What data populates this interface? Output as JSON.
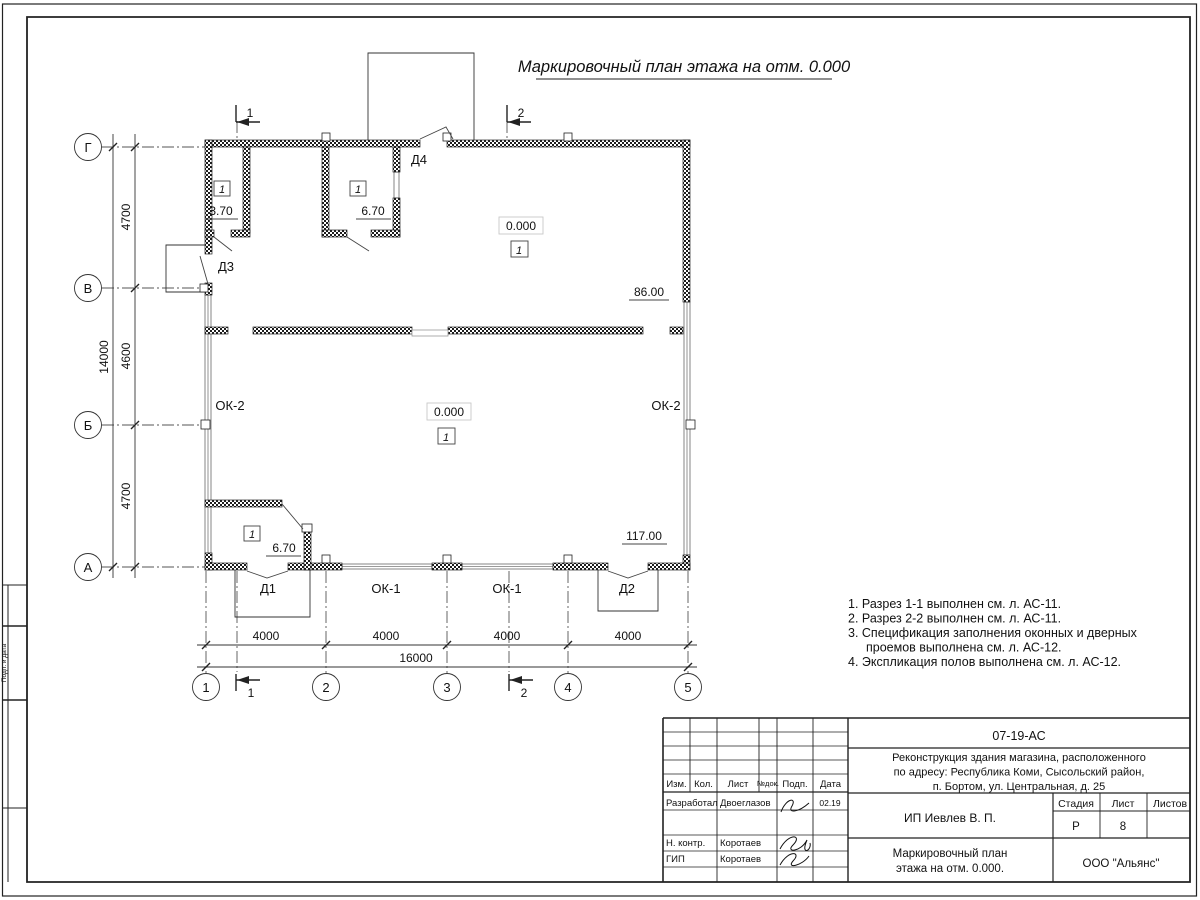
{
  "sheet": {
    "side_label": "Подп. и дата"
  },
  "title": "Маркировочный план этажа на отм. 0.000",
  "plan": {
    "axis_rows": [
      "Г",
      "В",
      "Б",
      "А"
    ],
    "axis_cols": [
      "1",
      "2",
      "3",
      "4",
      "5"
    ],
    "dims_vertical": [
      "4700",
      "4600",
      "4700"
    ],
    "dim_vertical_total": "14000",
    "dims_horizontal": [
      "4000",
      "4000",
      "4000",
      "4000"
    ],
    "dim_horizontal_total": "16000",
    "sections": {
      "s1": "1",
      "s2": "2"
    },
    "doors": {
      "d1": "Д1",
      "d2": "Д2",
      "d3": "Д3",
      "d4": "Д4"
    },
    "windows": {
      "ok1": "ОК-1",
      "ok2": "ОК-2"
    },
    "room_number": "1",
    "elevations": {
      "zero": "0.000",
      "e370": "3.70",
      "e670": "6.70",
      "e86": "86.00",
      "e117": "117.00"
    }
  },
  "notes": [
    "1. Разрез 1-1 выполнен см. л. АС-11.",
    "2. Разрез 2-2 выполнен см. л. АС-11.",
    "3. Спецификация заполнения оконных и дверных",
    "проемов выполнена см. л. АС-12.",
    "4. Экспликация полов выполнена см. л. АС-12."
  ],
  "title_block": {
    "doc_number": "07-19-АС",
    "project_lines": [
      "Реконструкция здания магазина, расположенного",
      "по адресу: Республика Коми, Сысольский район,",
      "п. Бортом, ул. Центральная, д. 25"
    ],
    "header_cols": [
      "Изм.",
      "Кол.",
      "Лист",
      "№док.",
      "Подп.",
      "Дата"
    ],
    "signers": [
      {
        "role": "Разработал",
        "name": "Двоеглазов",
        "date": "02.19"
      },
      {
        "role": "Н. контр.",
        "name": "Коротаев",
        "date": ""
      },
      {
        "role": "ГИП",
        "name": "Коротаев",
        "date": ""
      }
    ],
    "client": "ИП Иевлев В. П.",
    "stage_label": "Стадия",
    "sheet_label": "Лист",
    "sheets_label": "Листов",
    "stage": "Р",
    "sheet": "8",
    "sheets": "",
    "drawing_title_lines": [
      "Маркировочный план",
      "этажа на отм. 0.000."
    ],
    "company": "ООО \"Альянс\""
  }
}
